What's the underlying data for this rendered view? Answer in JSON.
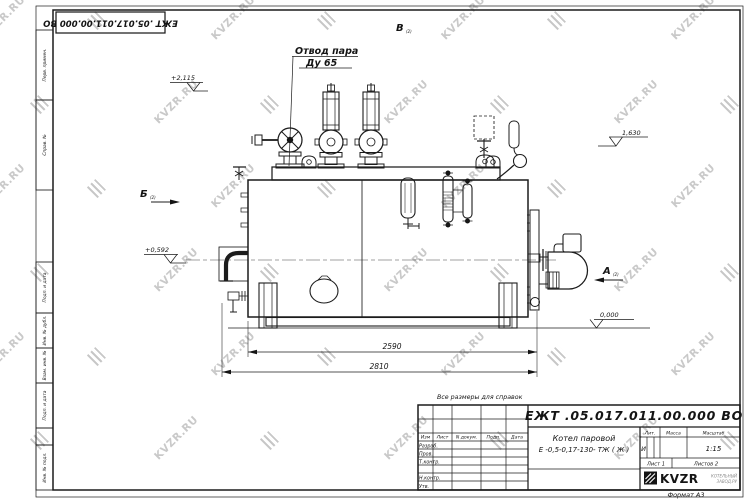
{
  "doc_number": "ЕЖТ .05.017.011.00.000  ВО",
  "watermark": {
    "text": "KVZR.RU"
  },
  "margin": {
    "perv_primen": "Перв. примен.",
    "sprav_no": "Справ. №",
    "podp_data_1": "Подп. и дата",
    "inv_dubl": "Инв. № дубл.",
    "vzam_inv": "Взам. инв. №",
    "podp_data_2": "Подп. и дата",
    "inv_podl": "Инв. № подл."
  },
  "drawing": {
    "callout_line1": "Отвод пара",
    "callout_line2": "Ду 65",
    "note": "Все размеры для справок",
    "views": {
      "a": "А",
      "b": "Б",
      "v": "В",
      "sheet_ref": "(2)"
    },
    "levels": {
      "top": "+2,115",
      "steam": "1,630",
      "axis": "+0,592",
      "ground": "0,000"
    },
    "dims": {
      "supports": "2590",
      "overall": "2810"
    }
  },
  "title_block": {
    "product_line1": "Котел паровой",
    "product_line2": "Е -0,5-0,17-130- ТЖ ( Ж )",
    "headers": {
      "izm": "Изм",
      "list": "Лист",
      "doc": "N докум.",
      "podp": "Подп.",
      "data": "Дата"
    },
    "rows": {
      "razrab": "Разраб.",
      "prov": "Пров.",
      "t_kontr": "Т.контр.",
      "n_kontr": "Н.контр.",
      "utv": "Утв."
    },
    "props": {
      "lit_h": "Лит.",
      "mass_h": "Масса",
      "scale_h": "Масштаб",
      "lit": "И",
      "scale": "1:15",
      "sheet": "Лист 1",
      "sheets": "Листов 2"
    },
    "brand": {
      "name": "KVZR",
      "sub1": "КОТЕЛЬНЫЙ",
      "sub2": "ЗАВОД.РУ"
    },
    "format": "Формат А3"
  }
}
